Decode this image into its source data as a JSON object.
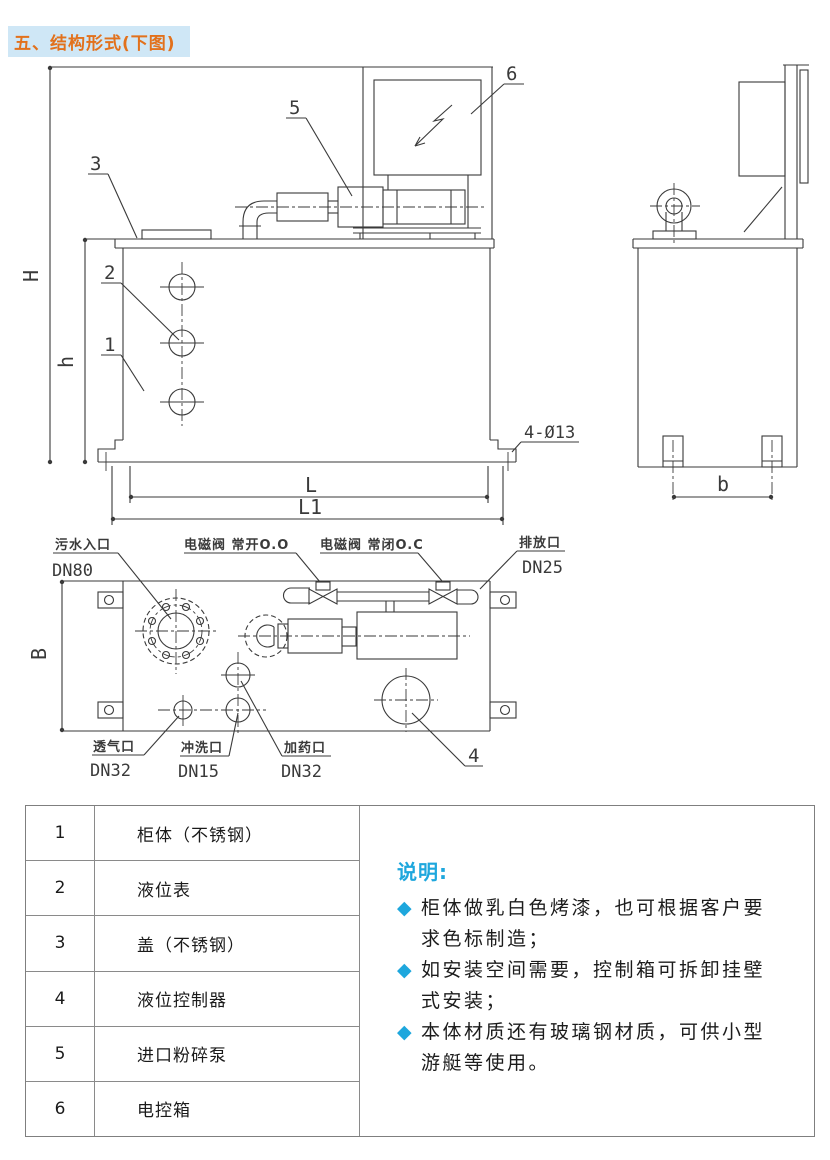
{
  "page": {
    "title": "五、结构形式(下图)"
  },
  "drawing": {
    "dims": {
      "H": "H",
      "h": "h",
      "L": "L",
      "L1": "L1",
      "b": "b",
      "B": "B",
      "holes": "4-Ø13"
    },
    "callouts": {
      "c1": "1",
      "c2": "2",
      "c3": "3",
      "c4": "4",
      "c5": "5",
      "c6": "6"
    },
    "labels": {
      "inlet": "污水入口",
      "inlet_dn": "DN80",
      "valve_open": "电磁阀 常开O.O",
      "valve_closed": "电磁阀 常闭O.C",
      "drain": "排放口",
      "drain_dn": "DN25",
      "vent": "透气口",
      "vent_dn": "DN32",
      "flush": "冲洗口",
      "flush_dn": "DN15",
      "dosing": "加药口",
      "dosing_dn": "DN32"
    }
  },
  "parts_table": {
    "rows": [
      {
        "no": "1",
        "name": "柜体（不锈钢）"
      },
      {
        "no": "2",
        "name": "液位表"
      },
      {
        "no": "3",
        "name": "盖（不锈钢）"
      },
      {
        "no": "4",
        "name": "液位控制器"
      },
      {
        "no": "5",
        "name": "进口粉碎泵"
      },
      {
        "no": "6",
        "name": "电控箱"
      }
    ]
  },
  "notes": {
    "title": "说明:",
    "bullet": "◆",
    "items": [
      "柜体做乳白色烤漆，也可根据客户要求色标制造；",
      "如安装空间需要，控制箱可拆卸挂壁式安装；",
      "本体材质还有玻璃钢材质，可供小型游艇等使用。"
    ]
  },
  "colors": {
    "accent_orange": "#e2711c",
    "title_bg": "#cfe7f6",
    "accent_cyan": "#1ea7dd",
    "line": "#3a3a3a"
  }
}
